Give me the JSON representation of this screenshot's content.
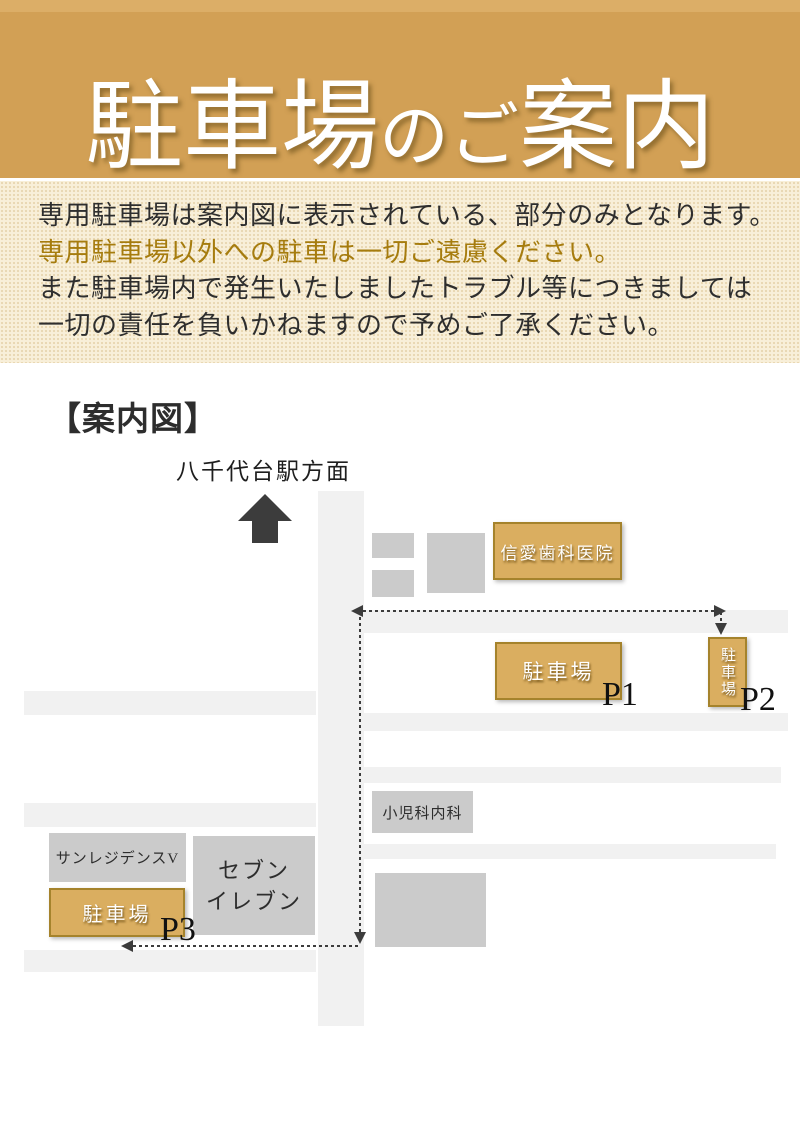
{
  "header": {
    "title_full": "駐車場のご案内",
    "title_parts": {
      "p1": "駐車場",
      "p2": "の",
      "p3": "ご",
      "p4": "案内"
    },
    "bg_color": "#d2a055",
    "text_color": "#ffffff"
  },
  "notice": {
    "bg_color": "#f8efd9",
    "lines": [
      {
        "text": "専用駐車場は案内図に表示されている、部分のみとなります。",
        "color": "#2e2e2e"
      },
      {
        "text": "専用駐車場以外への駐車は一切ご遠慮ください。",
        "color": "#a67c0e"
      },
      {
        "text": "また駐車場内で発生いたしましたトラブル等につきましては",
        "color": "#2e2e2e"
      },
      {
        "text": "一切の責任を負いかねますので予めご了承ください。",
        "color": "#2e2e2e"
      }
    ]
  },
  "map": {
    "section_title": "【案内図】",
    "station_direction_label": "八千代台駅方面",
    "colors": {
      "road": "#f1f1f1",
      "gray_building": "#cbcbcb",
      "parking_fill": "#daae60",
      "parking_border": "#a5832c",
      "route_arrow": "#3c3c3c"
    },
    "buildings": {
      "dental_clinic": {
        "label": "信愛歯科医院"
      },
      "parking_p1": {
        "label": "駐車場",
        "tag": "P1"
      },
      "parking_p2": {
        "label": "駐車場",
        "tag": "P2"
      },
      "parking_p3": {
        "label": "駐車場",
        "tag": "P3"
      },
      "pediatrics": {
        "label": "小児科内科"
      },
      "sun_residence": {
        "label": "サンレジデンスV"
      },
      "seven_eleven": {
        "line1": "セブン",
        "line2": "イレブン"
      }
    }
  }
}
